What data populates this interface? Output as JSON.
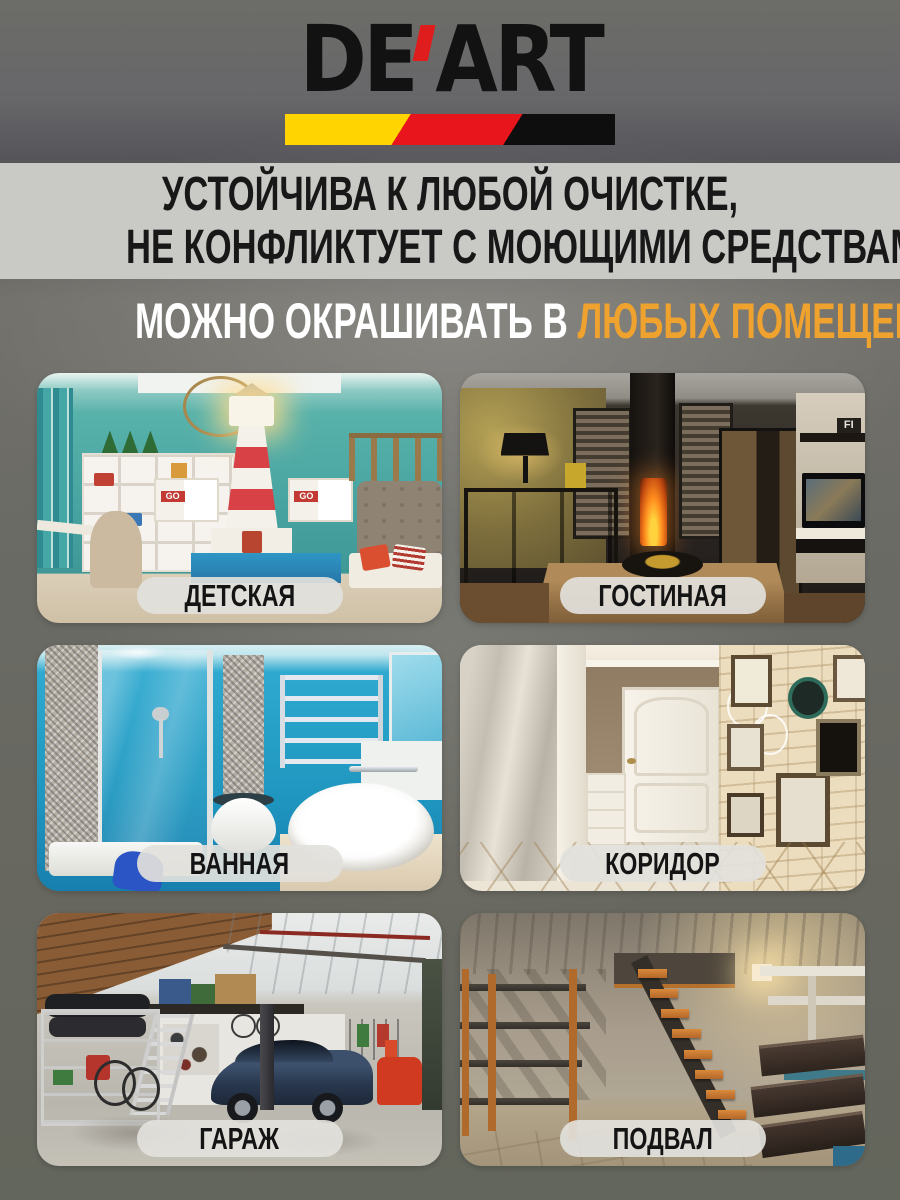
{
  "logo": {
    "prefix": "DE",
    "suffix": "ART",
    "full_name": "DE'ART",
    "colors": {
      "text": "#121212",
      "apostrophe": "#e01d1d",
      "stripe_yellow": "#ffd400",
      "stripe_red": "#e8161c",
      "stripe_black": "#0e0e0e"
    }
  },
  "headline": {
    "line1": "УСТОЙЧИВА К ЛЮБОЙ ОЧИСТКЕ,",
    "line2": "НЕ КОНФЛИКТУЕТ С МОЮЩИМИ СРЕДСТВАМИ",
    "band_color": "#c9cac6",
    "text_color": "#181818"
  },
  "subheadline": {
    "part1": "МОЖНО ОКРАШИВАТЬ В ",
    "part2": "ЛЮБЫХ ПОМЕЩЕНИЯХ",
    "part1_color": "#ffffff",
    "part2_color": "#f0a22e"
  },
  "rooms": [
    {
      "label": "ДЕТСКАЯ"
    },
    {
      "label": "ГОСТИНАЯ"
    },
    {
      "label": "ВАННАЯ"
    },
    {
      "label": "КОРИДОР"
    },
    {
      "label": "ГАРАЖ"
    },
    {
      "label": "ПОДВАЛ"
    }
  ],
  "photo_texts": {
    "kids_cabinet_tag": "GO",
    "living_shelf_letters": "FI"
  },
  "label_pill": {
    "bg": "rgba(226,225,220,0.92)",
    "text_color": "#141414"
  }
}
